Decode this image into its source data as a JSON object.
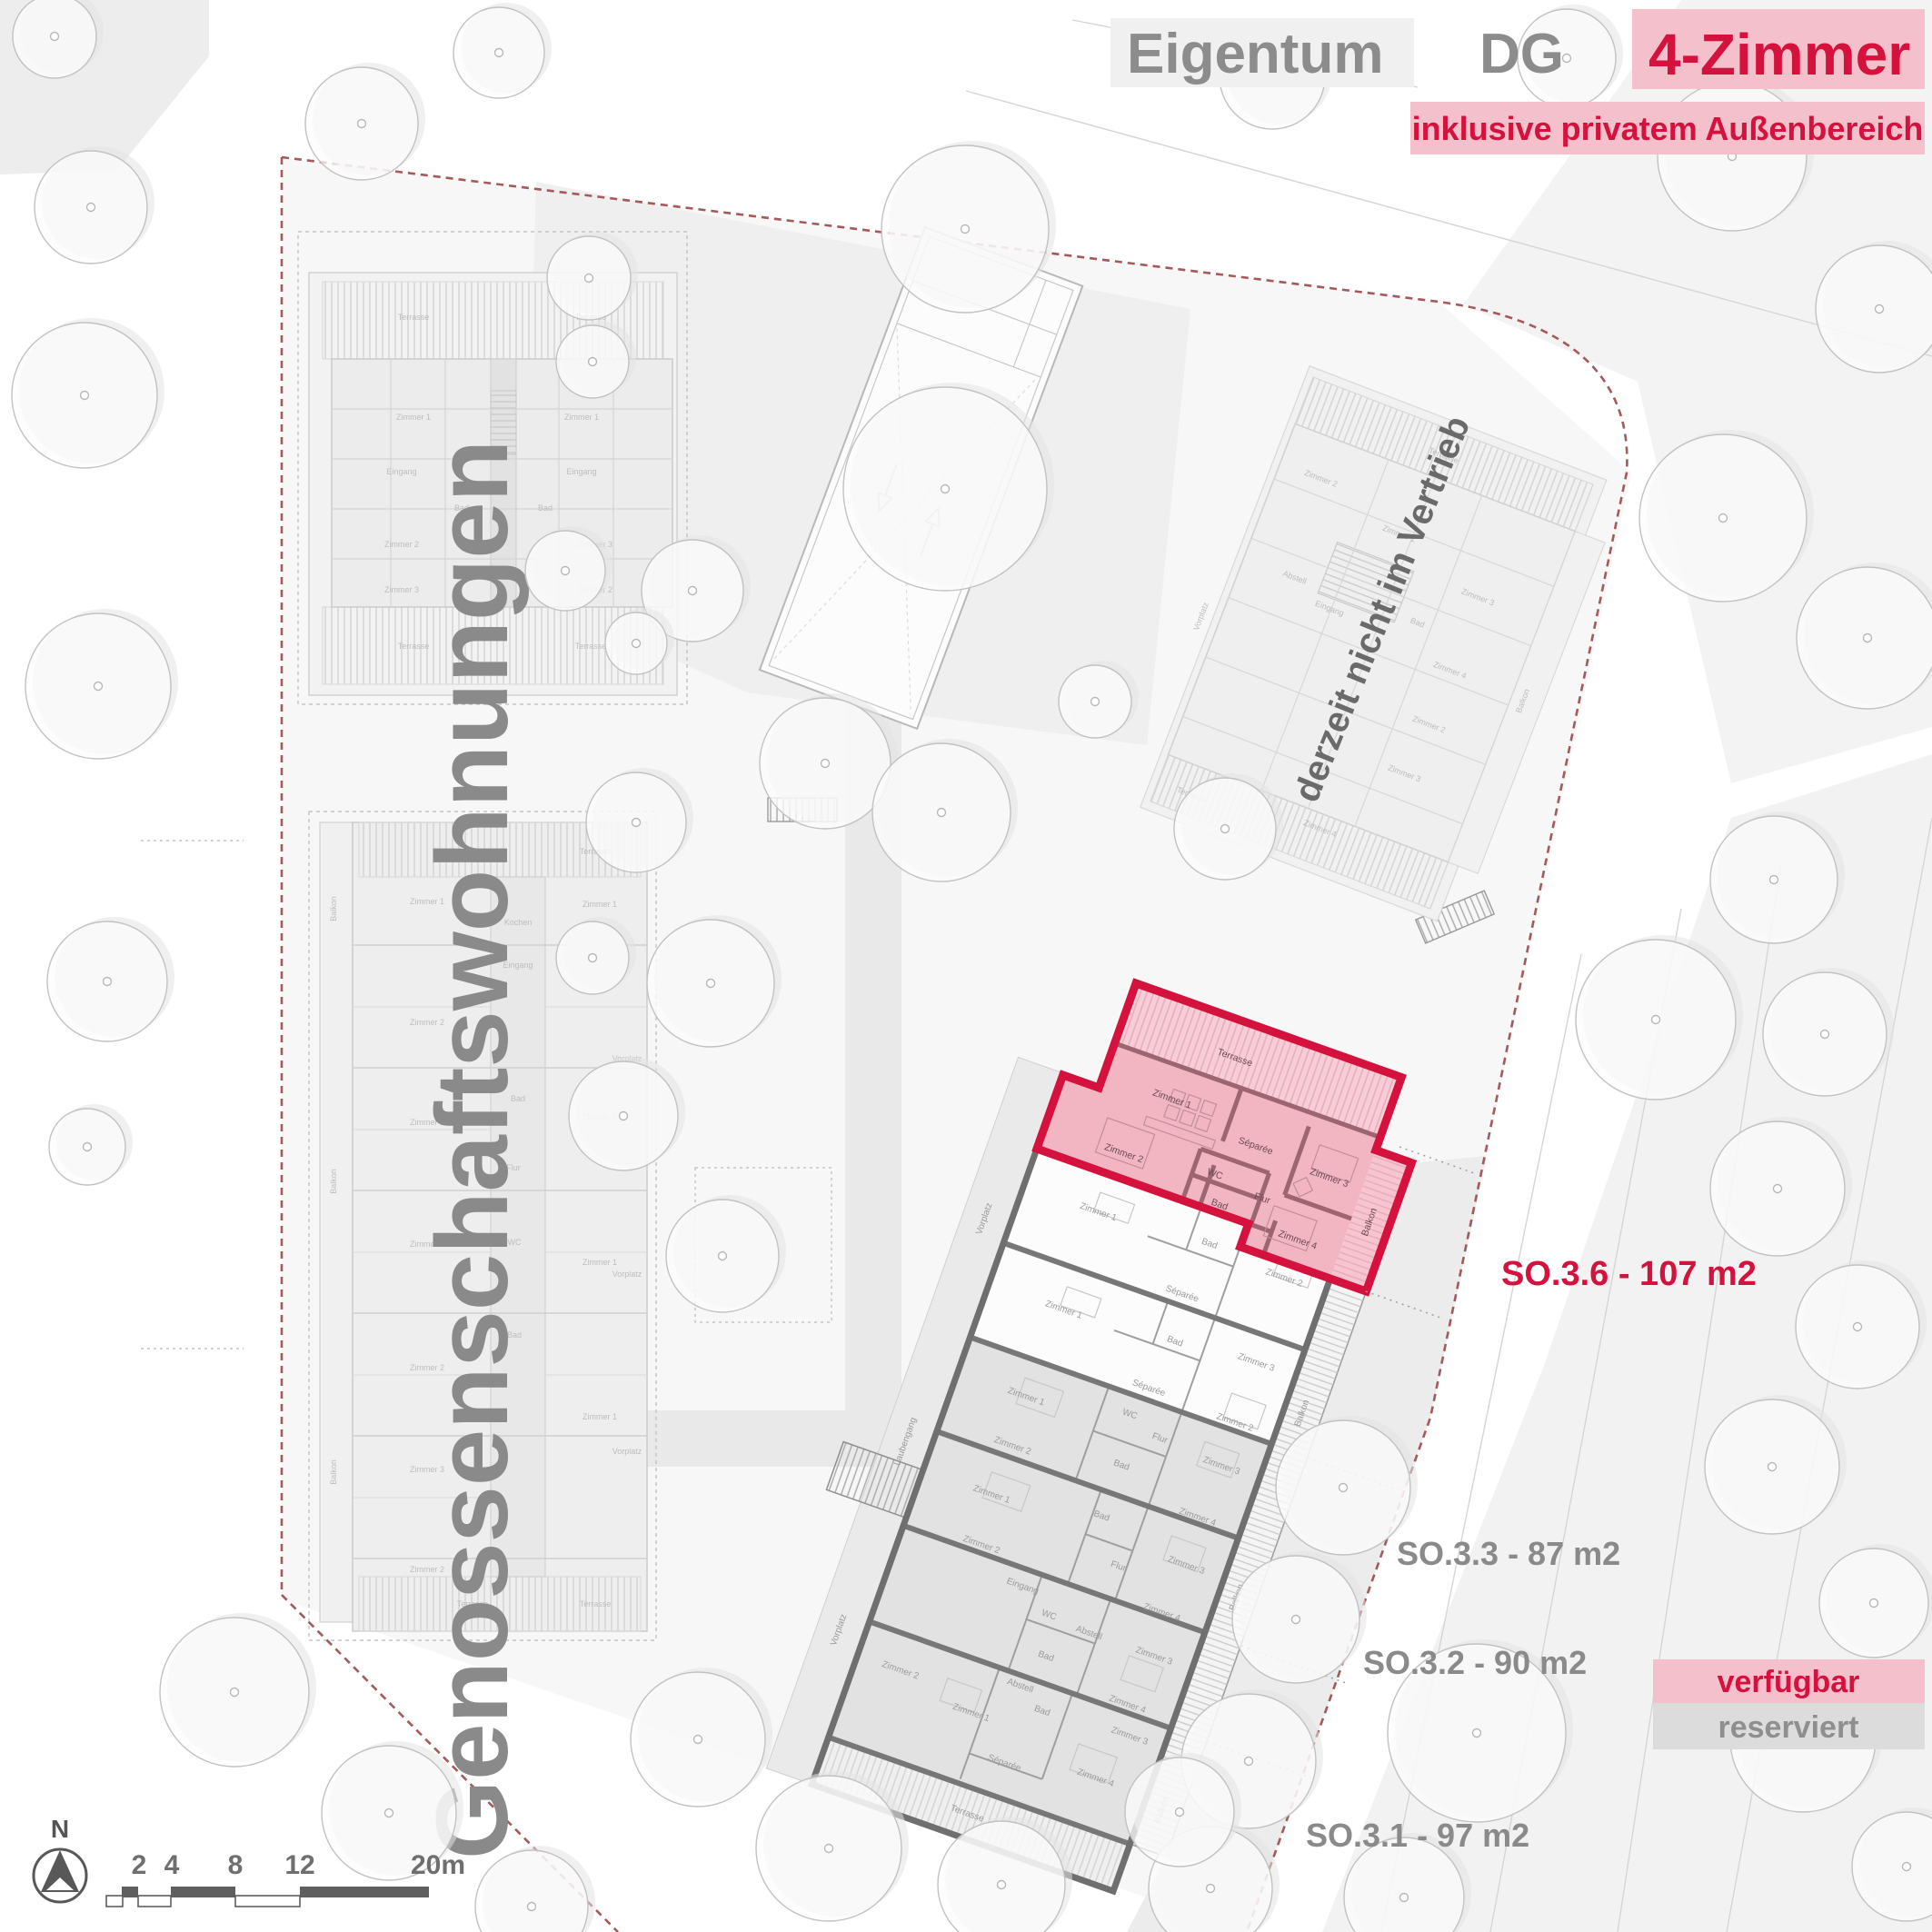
{
  "header": {
    "title_left": "Eigentum",
    "title_mid": "DG",
    "title_right": "4-Zimmer",
    "subtitle": "inklusive privatem Außenbereich"
  },
  "annotations": {
    "so36": "SO.3.6 - 107 m2",
    "so33": "SO.3.3 - 87 m2",
    "so32": "SO.3.2 - 90 m2",
    "so31": "SO.3.1 - 97 m2",
    "coop_building": "Genossenschaftswohnungen",
    "not_in_sale": "derzeit nicht im Vertrieb"
  },
  "legend": {
    "available": "verfügbar",
    "reserved": "reserviert"
  },
  "compass": {
    "north": "N"
  },
  "scalebar": {
    "t2": "2",
    "t4": "4",
    "t8": "8",
    "t12": "12",
    "t20": "20m"
  },
  "labels": {
    "terrasse": "Terrasse",
    "balkon": "Balkon",
    "zimmer1": "Zimmer 1",
    "zimmer2": "Zimmer 2",
    "zimmer3": "Zimmer 3",
    "zimmer4": "Zimmer 4",
    "bad": "Bad",
    "wc": "WC",
    "flur": "Flur",
    "separee": "Séparée",
    "eingang": "Eingang",
    "abstell": "Abstell",
    "vorplatz": "Vorplatz",
    "laubengang": "Laubengang",
    "kochen": "Kochen"
  },
  "colors": {
    "accent": "#d5113d",
    "accent_soft": "#f3c0cb",
    "highlight_fill": "#f2b6c3",
    "gray_text": "#8a8a8a",
    "reserved_fill": "#e2e2e2",
    "reserved_box": "#dcdcdc",
    "boundary": "#a4595b",
    "wall": "#6f6f6f",
    "wall_red": "#9c6570"
  }
}
